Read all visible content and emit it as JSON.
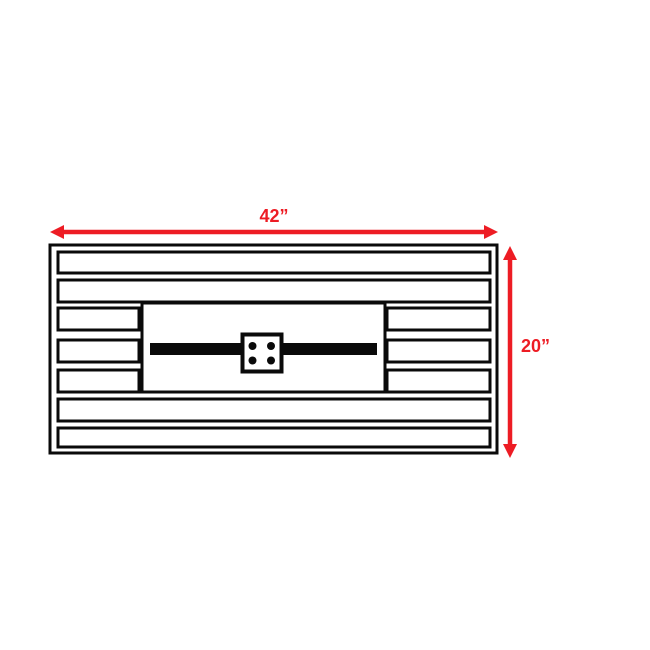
{
  "diagram": {
    "title": "fire-pit-table-top-dimension-drawing",
    "type": "dimension-drawing",
    "colors": {
      "dimension": "#ed1c24",
      "outline": "#0a0a0a",
      "fill": "#ffffff",
      "background": "#ffffff"
    },
    "dimensions": {
      "width": {
        "label": "42”",
        "value_inches": 42,
        "orientation": "horizontal"
      },
      "height": {
        "label": "20”",
        "value_inches": 20,
        "orientation": "vertical"
      }
    },
    "structure": {
      "slat_count": 7,
      "full_width_slats": 4,
      "split_slats": 3,
      "burner_igniter_dots": 4
    }
  }
}
